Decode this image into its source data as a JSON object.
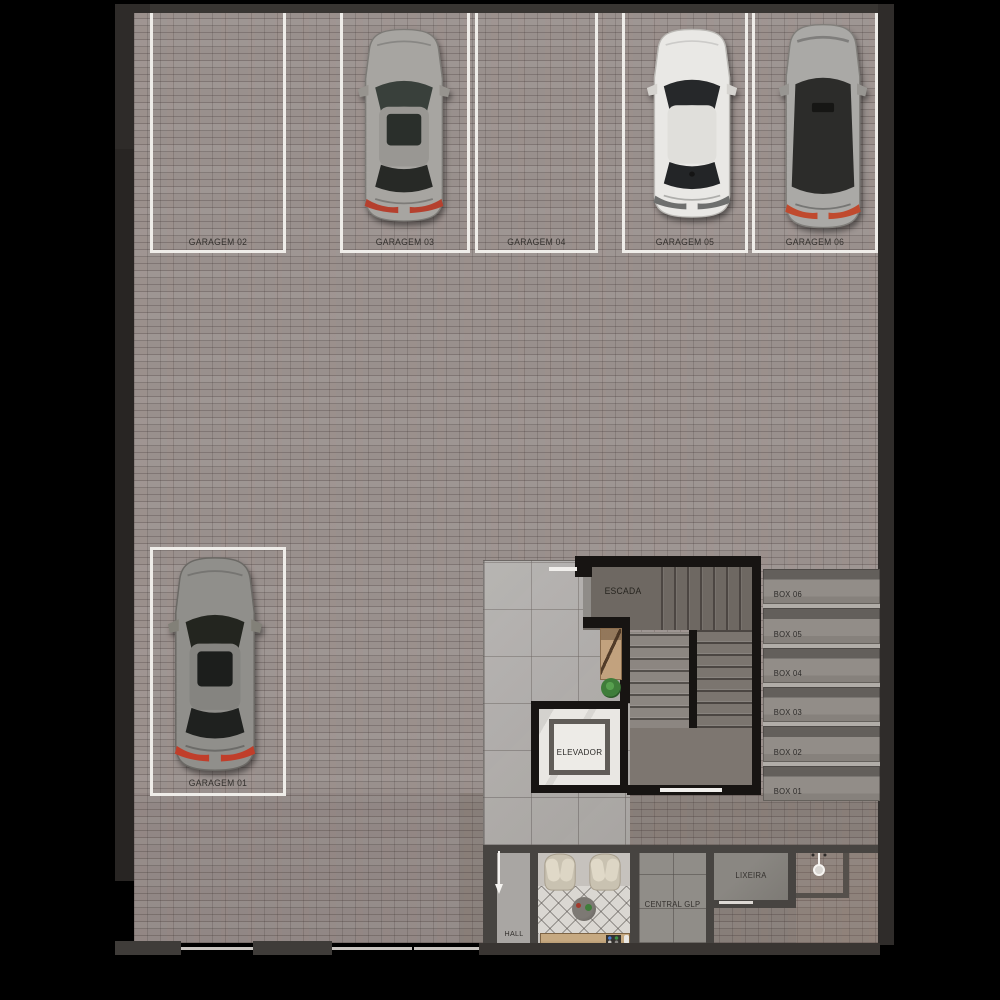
{
  "plan_type": "garage-floor-plan",
  "parking": {
    "stalls": [
      {
        "id": "garagem-02",
        "label": "GARAGEM 02",
        "occupied": false
      },
      {
        "id": "garagem-03",
        "label": "GARAGEM 03",
        "occupied": true,
        "car_color": "silver"
      },
      {
        "id": "garagem-04",
        "label": "GARAGEM 04",
        "occupied": false
      },
      {
        "id": "garagem-05",
        "label": "GARAGEM 05",
        "occupied": true,
        "car_color": "white"
      },
      {
        "id": "garagem-06",
        "label": "GARAGEM 06",
        "occupied": true,
        "car_color": "silver-dark-glass"
      },
      {
        "id": "garagem-01",
        "label": "GARAGEM 01",
        "occupied": true,
        "car_color": "gray"
      }
    ]
  },
  "core": {
    "stairs_label": "ESCADA",
    "elevator_label": "ELEVADOR"
  },
  "boxes": [
    {
      "label": "BOX 06"
    },
    {
      "label": "BOX 05"
    },
    {
      "label": "BOX 04"
    },
    {
      "label": "BOX 03"
    },
    {
      "label": "BOX 02"
    },
    {
      "label": "BOX 01"
    }
  ],
  "rooms": {
    "hall": "HALL",
    "central_glp": "CENTRAL GLP",
    "lixeira": "LIXEIRA"
  },
  "icons": {
    "entrance_arrow": "down-arrow",
    "water_point": "water-point"
  },
  "colors": {
    "background": "#000000",
    "paver_floor": "#99908d",
    "lobby_tile": "#b2afac",
    "core_wall": "#171412",
    "stall_line": "#efede9",
    "taillight_red": "#c03e2a",
    "plant_green": "#3f7d3a",
    "wood": "#c2a27e"
  }
}
